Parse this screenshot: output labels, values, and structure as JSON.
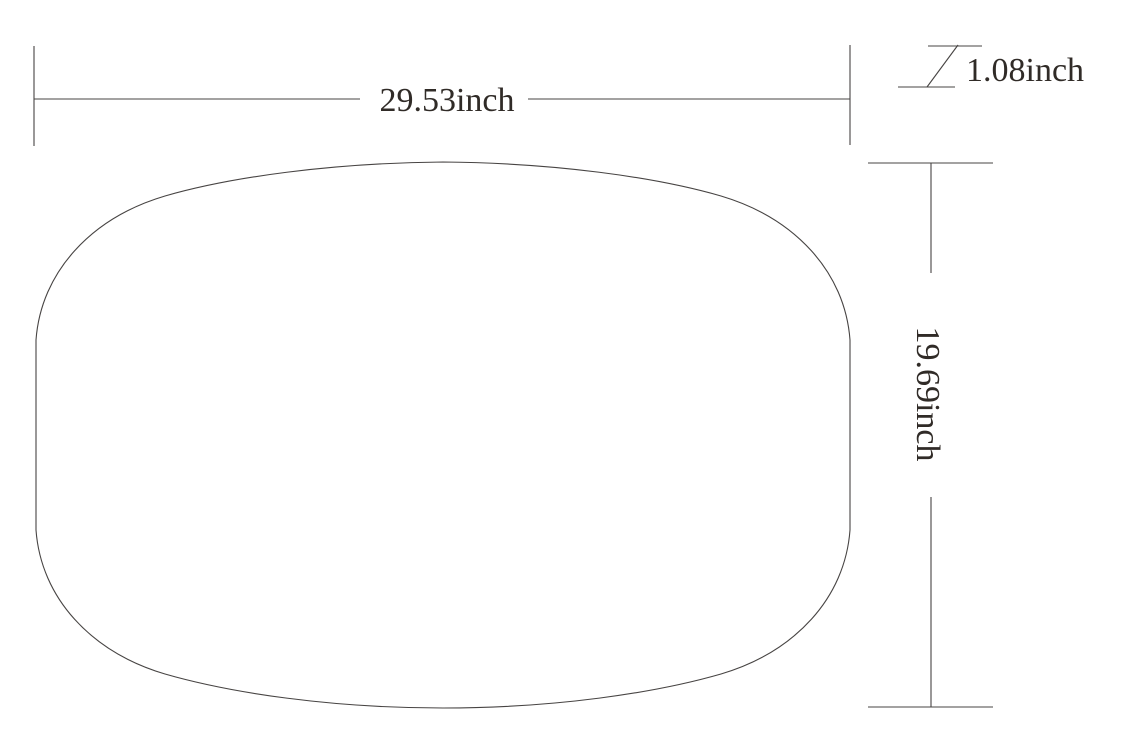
{
  "drawing": {
    "background_color": "#ffffff",
    "line_color": "#474443",
    "text_color": "#302b27",
    "dimensions": {
      "width": {
        "label": "29.53inch",
        "value": 29.53,
        "unit": "inch"
      },
      "height": {
        "label": "19.69inch",
        "value": 19.69,
        "unit": "inch"
      },
      "thickness": {
        "label": "1.08inch",
        "value": 1.08,
        "unit": "inch"
      }
    }
  }
}
